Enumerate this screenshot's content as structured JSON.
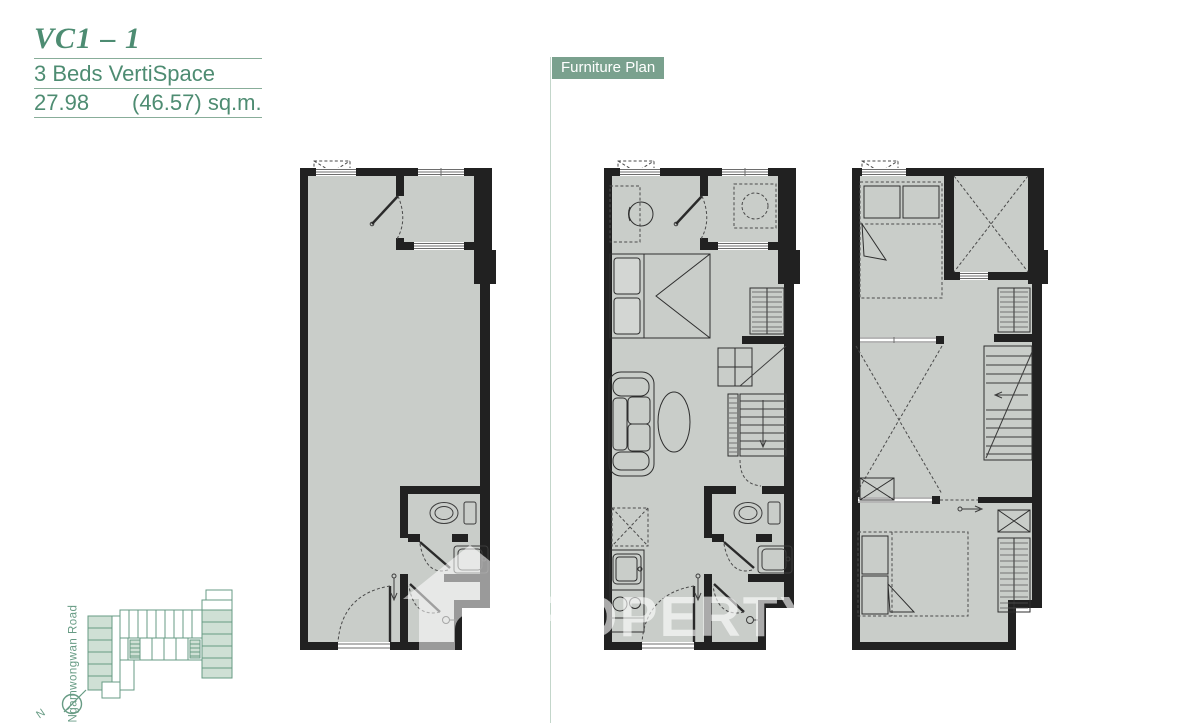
{
  "header": {
    "unit_code": "VC1 – 1",
    "unit_type": "3 Beds VertiSpace",
    "area_value": "27.98",
    "area_total": "(46.57) sq.m."
  },
  "section_label": "Furniture Plan",
  "watermark": {
    "line1": "PROPERTY",
    "line2": "SCOUT"
  },
  "site_map": {
    "road_label": "Ngamwongwan Road",
    "compass_label": "N"
  },
  "colors": {
    "accent_green": "#4d8c72",
    "label_bg": "#7aa18e",
    "underline_green": "#88ad99",
    "floor_gray": "#c9cdc9",
    "wall_black": "#212121",
    "site_map_green": "#679b84",
    "site_map_fill": "#cfe0d5"
  }
}
